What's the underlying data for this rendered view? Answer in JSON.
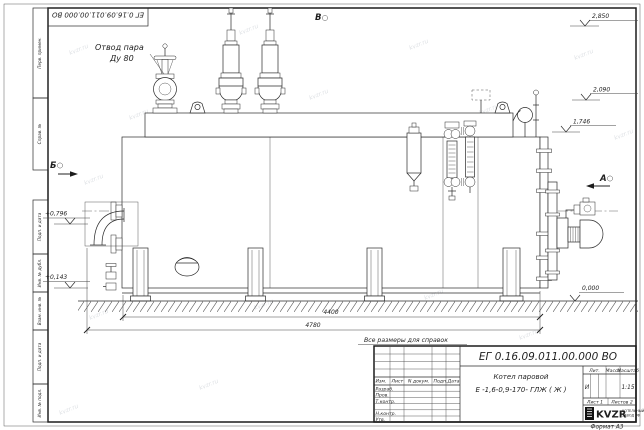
{
  "sheet": {
    "doc_number_stamp": "ЕГ 0.16.09.011.00.000  ВО",
    "note": "Все размеры для справок",
    "format_label": "Формат  А3",
    "view_b_top": "В",
    "view_a": "А",
    "view_b_left": "Б"
  },
  "labels": {
    "steam_outlet_1": "Отвод пара",
    "steam_outlet_2": "Ду 80"
  },
  "elevations": {
    "top": "2,850",
    "mid": "2,090",
    "low": "1,746",
    "left_upper": "+0,796",
    "left_lower": "+0,143",
    "zero": "0,000"
  },
  "dimensions": {
    "body_length": "4400",
    "overall_length": "4780"
  },
  "title_block": {
    "doc_number": "ЕГ 0.16.09.011.00.000  ВО",
    "name_line1": "Котел паровой",
    "name_line2": "Е -1,6-0,9-170- ГЛЖ ( Ж )",
    "cols": {
      "izm": "Изм.",
      "list": "Лист",
      "doc": "N докум.",
      "sign": "Подп.",
      "date": "Дата"
    },
    "rows": {
      "r1": "Разраб.",
      "r2": "Пров.",
      "r3": "Т.контр.",
      "r4": "Н.контр.",
      "r5": "Утв."
    },
    "lit_label": "Лит.",
    "mass_label": "Масса",
    "scale_label": "Масштаб",
    "lit_value": "И",
    "scale_value": "1:15",
    "sheet_no": "Лист 1",
    "sheets_total": "Листов 2",
    "logo_text": "KVZR",
    "company_line1": "КОТЕЛЬНЫЙ",
    "company_line2": "ЗАВОД РФ"
  },
  "side_strip": {
    "c1": "Перв. примен.",
    "c2": "Справ. №",
    "c3": "Подп. и дата",
    "c4": "Инв. № дубл.",
    "c5": "Взам. инв. №",
    "c6": "Подп. и дата",
    "c7": "Инв. № подл."
  },
  "watermark": {
    "text": "kvzr.ru"
  }
}
